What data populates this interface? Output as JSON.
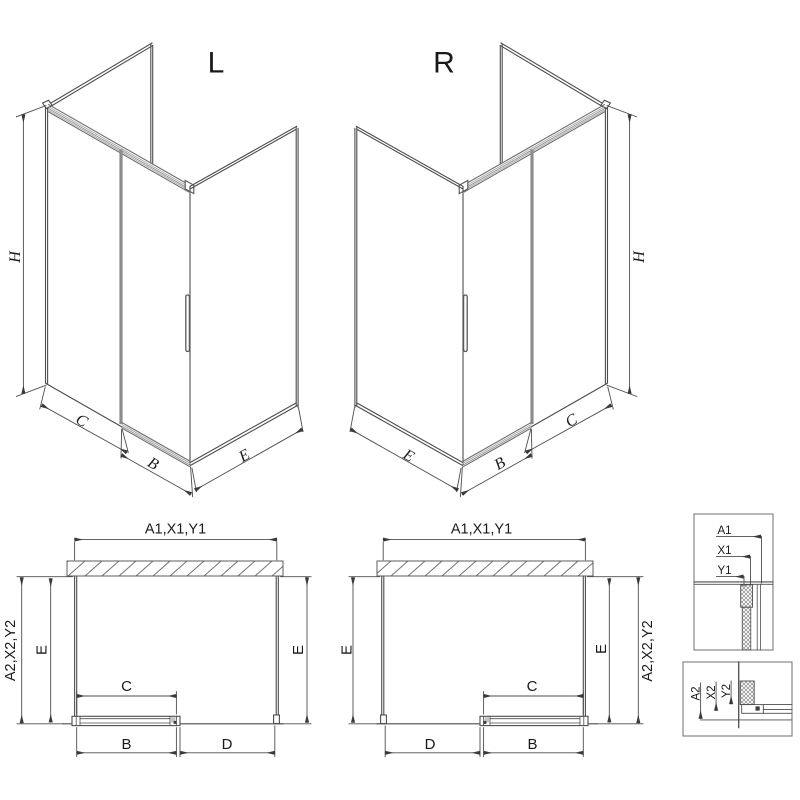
{
  "diagram": {
    "iso_left": {
      "title": "L",
      "dim_height": "H",
      "dim_fixed": "C",
      "dim_door": "B",
      "dim_side": "E"
    },
    "iso_right": {
      "title": "R",
      "dim_height": "H",
      "dim_fixed": "C",
      "dim_door": "B",
      "dim_side": "E"
    },
    "plan_left": {
      "dim_width_top": "A1,X1,Y1",
      "dim_depth_outer": "A2,X2,Y2",
      "dim_depth_inner": "E",
      "dim_depth_far": "E",
      "dim_fixed": "C",
      "dim_door": "B",
      "dim_opening": "D"
    },
    "plan_right": {
      "dim_width_top": "A1,X1,Y1",
      "dim_depth_outer": "A2,X2,Y2",
      "dim_depth_inner": "E",
      "dim_depth_far": "E",
      "dim_fixed": "C",
      "dim_door": "B",
      "dim_opening": "D"
    },
    "detail_wall": {
      "ref_a1": "A1",
      "ref_x1": "X1",
      "ref_y1": "Y1"
    },
    "detail_floor": {
      "ref_a2": "A2",
      "ref_x2": "X2",
      "ref_y2": "Y2"
    },
    "colors": {
      "line": "#4d4d4d",
      "light_line": "#9a9a9a",
      "glass_edge": "#8c8c8c",
      "text": "#1a1a1a",
      "background": "#ffffff"
    }
  }
}
